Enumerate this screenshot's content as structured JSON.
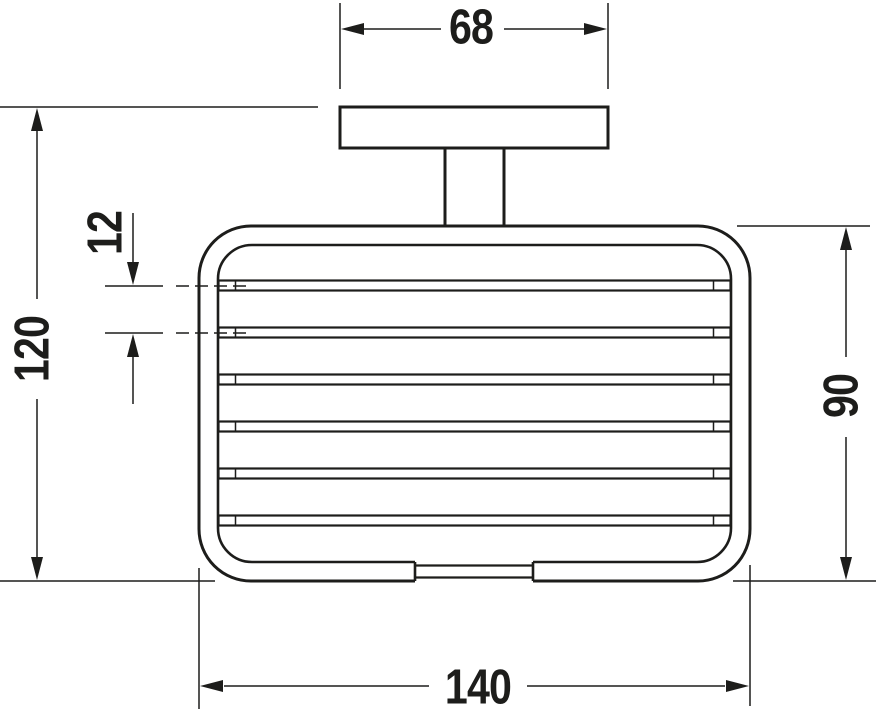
{
  "drawing": {
    "background_color": "#ffffff",
    "line_color": "#1d1d1b",
    "labels": {
      "plate_width": "68",
      "wire_spacing": "12",
      "overall_height": "120",
      "basket_height": "90",
      "basket_width": "140"
    }
  }
}
